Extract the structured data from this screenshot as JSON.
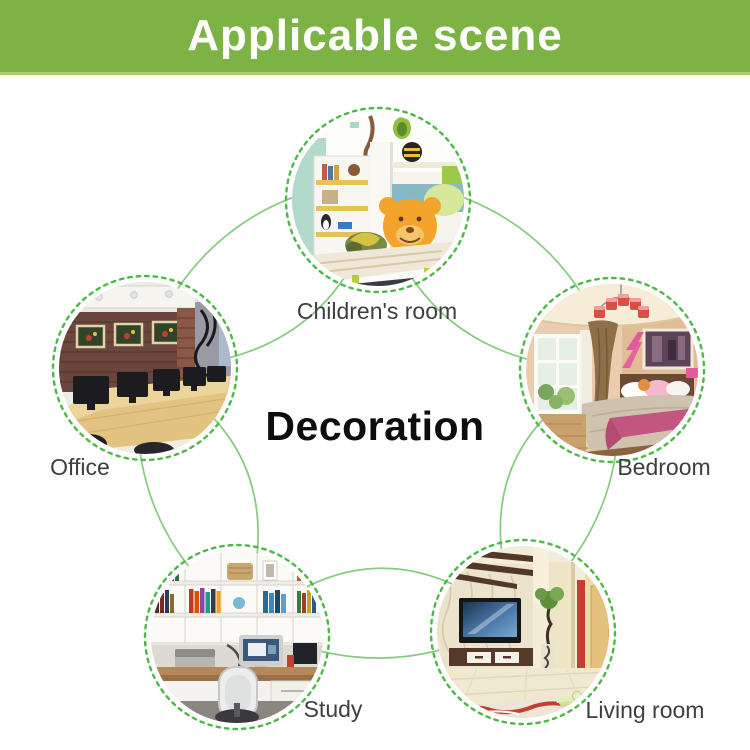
{
  "header": {
    "title": "Applicable scene",
    "bg_color": "#7db344",
    "edge_color": "#a9cc72",
    "text_color": "#ffffff"
  },
  "center_label": "Decoration",
  "colors": {
    "solid_curve": "#86cb7f",
    "dashed_ring": "#4db848",
    "label_text": "#3f3f3f",
    "center_text": "#0d0d0d"
  },
  "scenes": [
    {
      "id": "children-room",
      "label": "Children's room"
    },
    {
      "id": "office",
      "label": "Office"
    },
    {
      "id": "bedroom",
      "label": "Bedroom"
    },
    {
      "id": "study",
      "label": "Study"
    },
    {
      "id": "living-room",
      "label": "Living room"
    }
  ]
}
